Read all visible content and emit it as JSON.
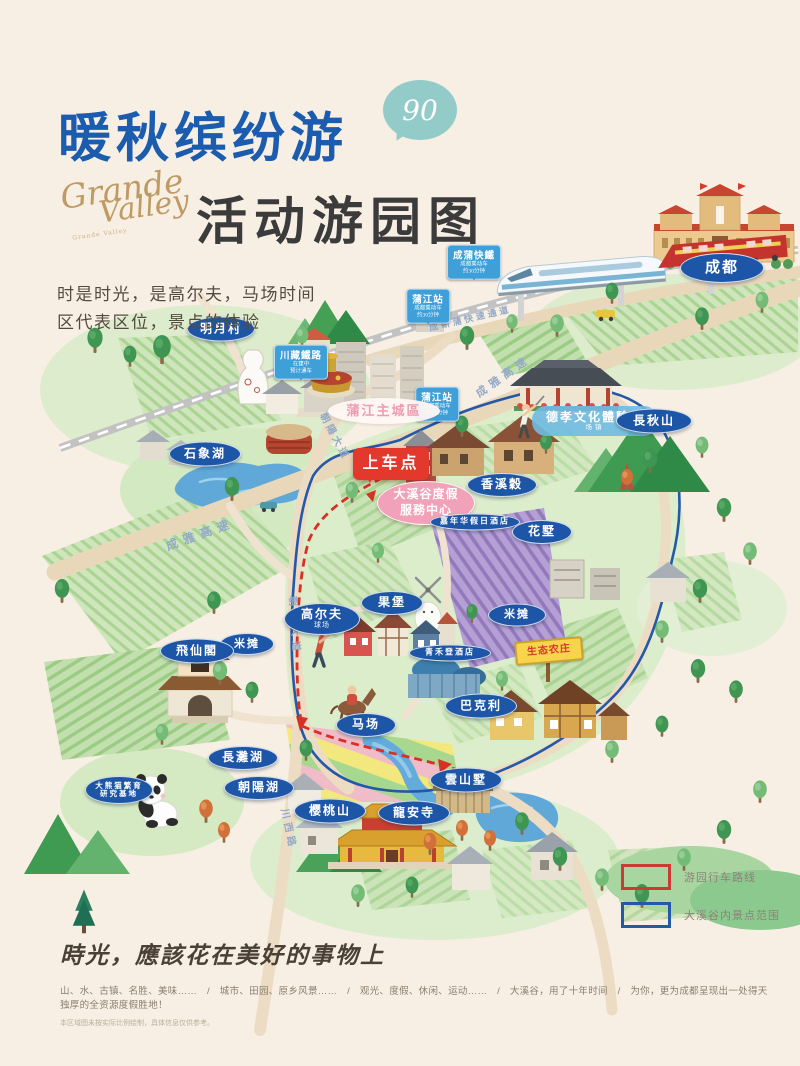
{
  "poster": {
    "title": "暖秋缤纷游",
    "bubble_text": "90",
    "script_line1": "Grande",
    "script_line2": "Valley",
    "script_caption": "Grande Valley",
    "subtitle": "活动游园图",
    "intro_line1": "时是时光，是高尔夫，马场时间",
    "intro_line2": "区代表区位，景点的体验"
  },
  "legend": {
    "route_label": "游园行车路线",
    "boundary_label": "大溪谷内景点范围"
  },
  "footer": {
    "slogan": "時光，應該花在美好的事物上",
    "line": "山、水、古镇、名胜、美味……　/　城市、田园、原乡风景……　/　观光、度假、休闲、运动……　/　大溪谷，用了十年时间　/　为你，更为成都呈现出一处得天独厚的全资源度假胜地！",
    "note": "本区域图未按实际比例绘制，具体信息仅供参考。"
  },
  "colors": {
    "background": "#f8efe4",
    "title_blue": "#1b5cae",
    "bubble_teal": "#93cbc8",
    "script_gold": "#bf9a63",
    "marker_blue": "#1d56a6",
    "marker_pink": "#f2a2b8",
    "boarding_red": "#e2392c",
    "sign_skyblue": "#3f9fd8",
    "route_red": "#d93025",
    "boundary_blue": "#2458a8",
    "eco_sign_yellow": "#f7d44b"
  },
  "markers": [
    {
      "name": "marker-mingyuecun",
      "type": "blue",
      "x": 221,
      "y": 329,
      "w": 66,
      "h": 23,
      "fs": 12,
      "label": "明月村"
    },
    {
      "name": "marker-chengdu",
      "type": "blue",
      "x": 722,
      "y": 268,
      "w": 82,
      "h": 28,
      "fs": 15,
      "label": "成都"
    },
    {
      "name": "marker-pujiang-city",
      "type": "pinklight",
      "x": 384,
      "y": 411,
      "w": 112,
      "h": 26,
      "fs": 13,
      "label": "蒲江主城區"
    },
    {
      "name": "marker-shixianghu",
      "type": "blue",
      "x": 205,
      "y": 454,
      "w": 70,
      "h": 23,
      "fs": 12,
      "label": "石象湖"
    },
    {
      "name": "marker-boarding-point",
      "type": "red",
      "x": 391,
      "y": 464,
      "w": 76,
      "h": 32,
      "fs": 16,
      "label": "上车点"
    },
    {
      "name": "marker-visitor-center",
      "type": "pink",
      "x": 426,
      "y": 503,
      "w": 96,
      "h": 42,
      "fs": 12,
      "label": "大溪谷度假",
      "label2": "服務中心"
    },
    {
      "name": "marker-xiangxigu",
      "type": "blue",
      "x": 502,
      "y": 485,
      "w": 68,
      "h": 22,
      "fs": 12,
      "label": "香溪穀"
    },
    {
      "name": "marker-hotel-jianianhua",
      "type": "blue",
      "x": 475,
      "y": 522,
      "w": 88,
      "h": 15,
      "fs": 8,
      "label": "嘉年华假日酒店"
    },
    {
      "name": "marker-dexiao-culture-zone",
      "type": "lightblue",
      "x": 595,
      "y": 421,
      "w": 126,
      "h": 30,
      "fs": 12,
      "label": "德孝文化體驗區",
      "sub": "场镇"
    },
    {
      "name": "marker-changqiushan",
      "type": "blue",
      "x": 654,
      "y": 421,
      "w": 74,
      "h": 23,
      "fs": 12,
      "label": "長秋山"
    },
    {
      "name": "marker-huashu",
      "type": "blue",
      "x": 542,
      "y": 532,
      "w": 58,
      "h": 22,
      "fs": 12,
      "label": "花墅"
    },
    {
      "name": "marker-golf-course",
      "type": "blue",
      "x": 322,
      "y": 619,
      "w": 74,
      "h": 30,
      "fs": 12,
      "label": "高尔夫",
      "sub": "球场"
    },
    {
      "name": "marker-guobao",
      "type": "blue",
      "x": 392,
      "y": 603,
      "w": 60,
      "h": 22,
      "fs": 12,
      "label": "果堡"
    },
    {
      "name": "marker-mitan-east",
      "type": "blue",
      "x": 517,
      "y": 615,
      "w": 56,
      "h": 21,
      "fs": 11,
      "label": "米摊"
    },
    {
      "name": "marker-mitan-west",
      "type": "blue",
      "x": 247,
      "y": 644,
      "w": 52,
      "h": 20,
      "fs": 11,
      "label": "米摊"
    },
    {
      "name": "marker-feixiange",
      "type": "blue",
      "x": 197,
      "y": 651,
      "w": 72,
      "h": 23,
      "fs": 12,
      "label": "飛仙閣"
    },
    {
      "name": "marker-hotel-qinghe",
      "type": "blue",
      "x": 450,
      "y": 653,
      "w": 80,
      "h": 15,
      "fs": 8,
      "label": "青禾登酒店"
    },
    {
      "name": "marker-machang",
      "type": "blue",
      "x": 366,
      "y": 725,
      "w": 58,
      "h": 22,
      "fs": 12,
      "label": "马场"
    },
    {
      "name": "marker-bakeli",
      "type": "blue",
      "x": 481,
      "y": 706,
      "w": 70,
      "h": 23,
      "fs": 12,
      "label": "巴克利"
    },
    {
      "name": "marker-yunshanshu",
      "type": "blue",
      "x": 466,
      "y": 780,
      "w": 70,
      "h": 23,
      "fs": 12,
      "label": "雲山墅"
    },
    {
      "name": "marker-yingtaoshan",
      "type": "blue",
      "x": 330,
      "y": 811,
      "w": 70,
      "h": 23,
      "fs": 12,
      "label": "樱桃山"
    },
    {
      "name": "marker-longansi",
      "type": "blue",
      "x": 414,
      "y": 813,
      "w": 70,
      "h": 23,
      "fs": 12,
      "label": "龍安寺"
    },
    {
      "name": "marker-changtanhu",
      "type": "blue",
      "x": 243,
      "y": 758,
      "w": 68,
      "h": 22,
      "fs": 12,
      "label": "長灘湖"
    },
    {
      "name": "marker-chaoyanghu",
      "type": "blue",
      "x": 259,
      "y": 788,
      "w": 68,
      "h": 22,
      "fs": 12,
      "label": "朝陽湖"
    },
    {
      "name": "marker-panda-base",
      "type": "blue2",
      "x": 119,
      "y": 790,
      "w": 66,
      "h": 26,
      "fs": 7.5,
      "label": "大熊猫繁育",
      "label2": "研究基地"
    },
    {
      "name": "marker-eco-farm-sign",
      "type": "yellow",
      "x": 549,
      "y": 651,
      "w": 64,
      "h": 20,
      "fs": 10,
      "label": "生态农庄",
      "rot": -5
    }
  ],
  "signs": [
    {
      "name": "sign-chengpu-rail",
      "x": 474,
      "y": 262,
      "label": "成蒲快鐵",
      "sub1": "成都乘动车",
      "sub2": "约30分钟"
    },
    {
      "name": "sign-pujiang-station-1",
      "x": 428,
      "y": 306,
      "label": "蒲江站",
      "sub1": "成都乘动车",
      "sub2": "约30分钟"
    },
    {
      "name": "sign-pujiang-station-2",
      "x": 437,
      "y": 404,
      "label": "蒲江站",
      "sub1": "成都乘动车",
      "sub2": "约45分钟"
    },
    {
      "name": "sign-chuanzang-rail",
      "x": 301,
      "y": 362,
      "label": "川藏鐵路",
      "sub1": "在建中",
      "sub2": "预计通车"
    }
  ],
  "road_labels": [
    {
      "name": "road-label-chengxinpu",
      "text": "成新蒲快速通道",
      "x": 470,
      "y": 318,
      "rot": -13,
      "fs": 9,
      "ls": 3
    },
    {
      "name": "road-label-chengya-ne",
      "text": "成雅高速",
      "x": 503,
      "y": 376,
      "rot": -35,
      "fs": 11,
      "ls": 5
    },
    {
      "name": "road-label-chengya-sw",
      "text": "成雅高速",
      "x": 200,
      "y": 534,
      "rot": -20,
      "fs": 12,
      "ls": 6
    },
    {
      "name": "road-label-chaoyang-n",
      "text": "朝陽大道",
      "x": 336,
      "y": 436,
      "rot": 62,
      "fs": 10,
      "ls": 3
    },
    {
      "name": "road-label-chaoyang-s",
      "text": "朝陽大道",
      "x": 296,
      "y": 626,
      "rot": 86,
      "fs": 10,
      "ls": 5
    },
    {
      "name": "road-label-chuanxi",
      "text": "川西路",
      "x": 290,
      "y": 829,
      "rot": 78,
      "fs": 10,
      "ls": 4
    }
  ]
}
